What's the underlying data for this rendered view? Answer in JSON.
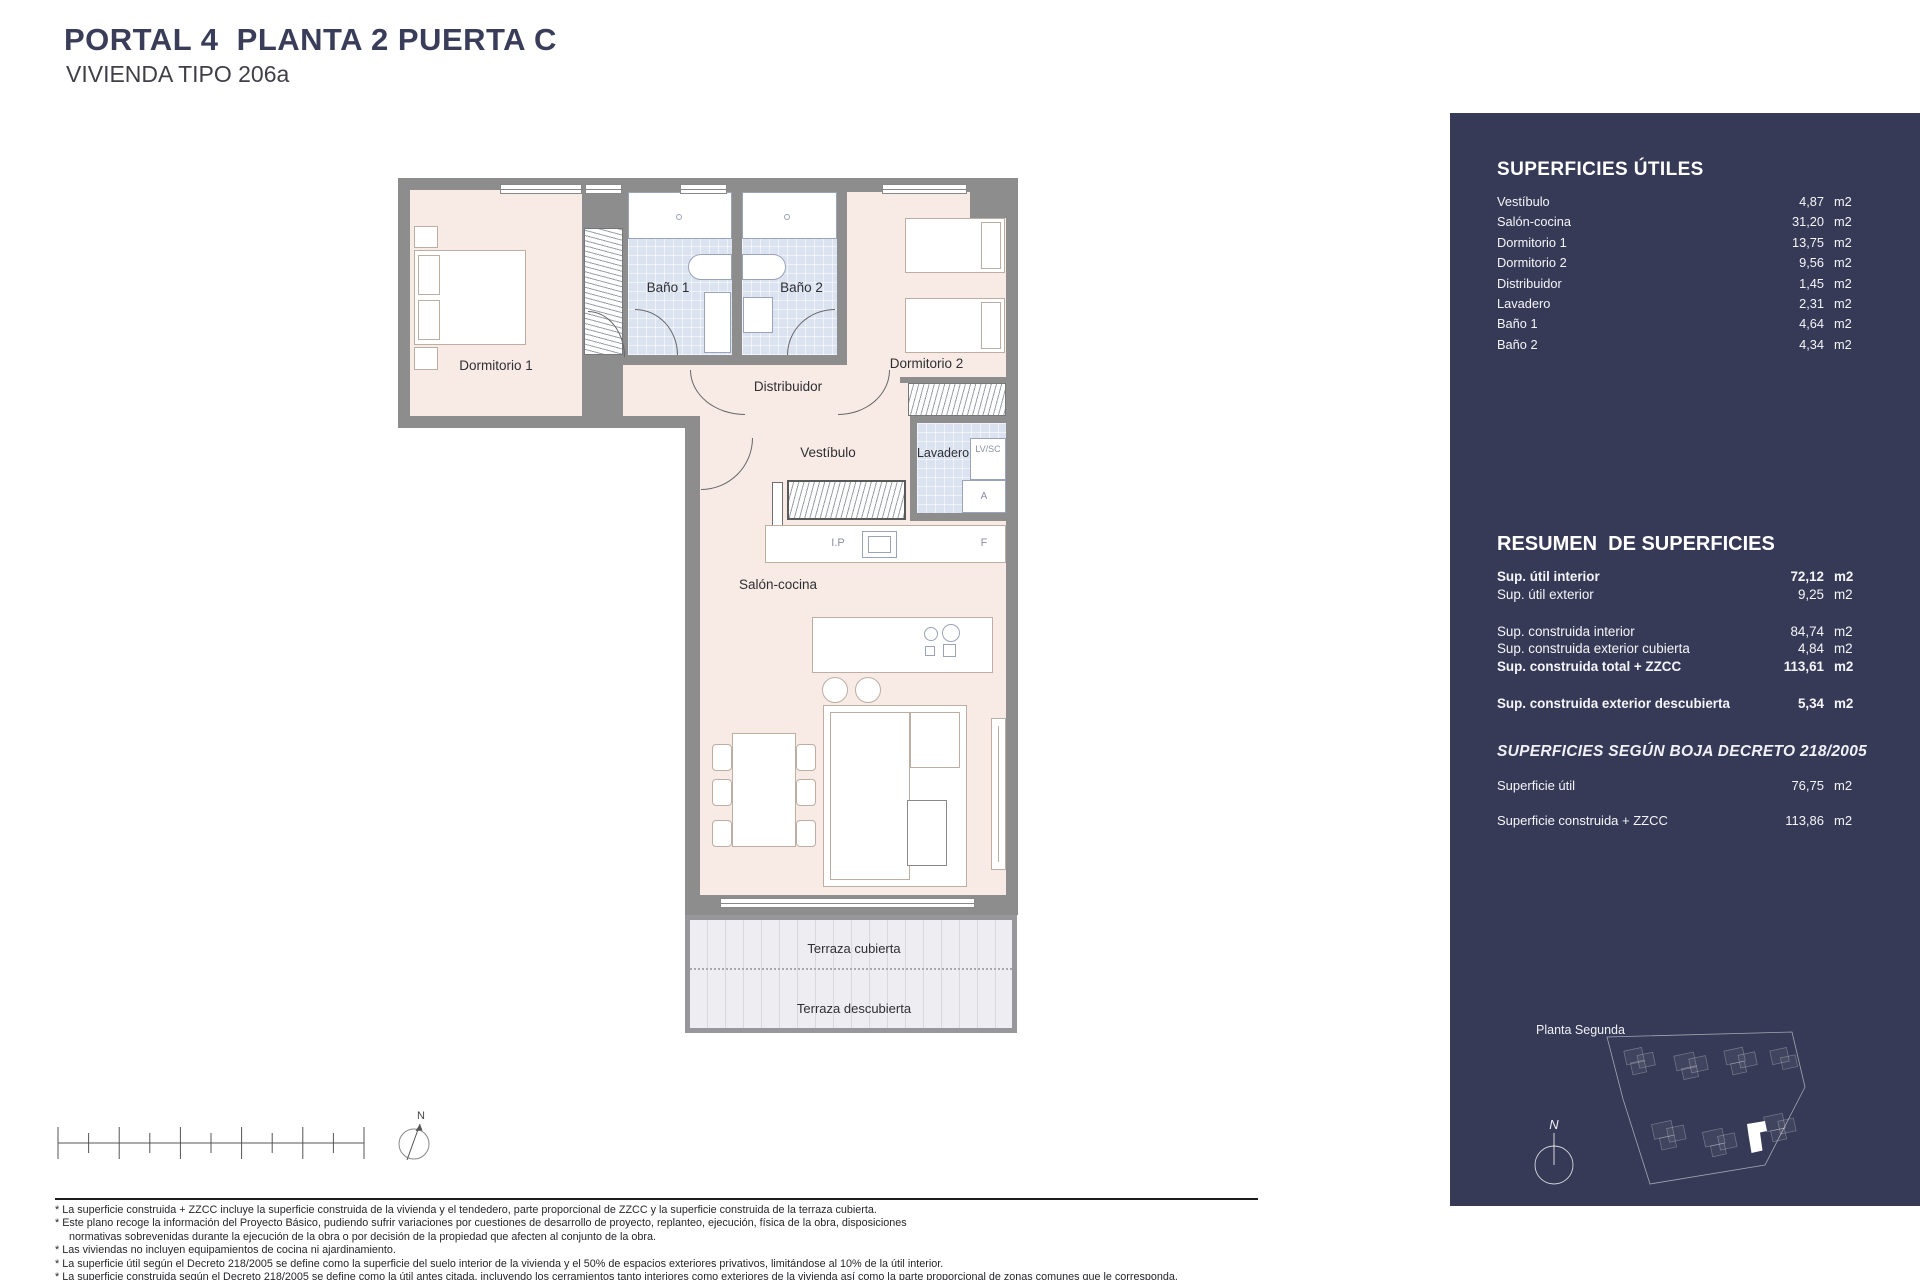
{
  "header": {
    "title": "PORTAL 4  PLANTA 2 PUERTA C",
    "subtitle": "VIVIENDA TIPO 206a"
  },
  "plan": {
    "rooms": {
      "dormitorio1": "Dormitorio 1",
      "bano1": "Baño 1",
      "bano2": "Baño 2",
      "dormitorio2": "Dormitorio 2",
      "distribuidor": "Distribuidor",
      "vestibulo": "Vestíbulo",
      "lavadero": "Lavadero",
      "salon": "Salón-cocina",
      "terraza_cubierta": "Terraza cubierta",
      "terraza_descubierta": "Terraza descubierta"
    },
    "labels": {
      "lv_sc": "LV/SC",
      "a": "A",
      "ip": "I.P",
      "f": "F"
    },
    "north": "N"
  },
  "sidebar": {
    "bg": "#373a56",
    "unit": "m2",
    "superficies_utiles": {
      "title": "SUPERFICIES ÚTILES",
      "rows": [
        {
          "label": "Vestíbulo",
          "value": "4,87"
        },
        {
          "label": "Salón-cocina",
          "value": "31,20"
        },
        {
          "label": "Dormitorio 1",
          "value": "13,75"
        },
        {
          "label": "Dormitorio 2",
          "value": "9,56"
        },
        {
          "label": "Distribuidor",
          "value": "1,45"
        },
        {
          "label": "Lavadero",
          "value": "2,31"
        },
        {
          "label": "Baño 1",
          "value": "4,64"
        },
        {
          "label": "Baño 2",
          "value": "4,34"
        }
      ]
    },
    "resumen": {
      "title": "RESUMEN  DE SUPERFICIES",
      "rows": [
        {
          "label": "Sup. útil interior",
          "value": "72,12"
        },
        {
          "label": "Sup. útil exterior",
          "value": "9,25"
        },
        {
          "label": "Sup. construida interior",
          "value": "84,74"
        },
        {
          "label": "Sup. construida exterior cubierta",
          "value": "4,84"
        },
        {
          "label": "Sup. construida total + ZZCC",
          "value": "113,61"
        },
        {
          "label": "Sup. construida exterior descubierta",
          "value": "5,34"
        }
      ]
    },
    "boja": {
      "title": "SUPERFICIES SEGÚN BOJA DECRETO 218/2005",
      "rows": [
        {
          "label": "Superficie útil",
          "value": "76,75"
        },
        {
          "label": "Superficie construida + ZZCC",
          "value": "113,86"
        }
      ]
    },
    "site": {
      "label": "Planta Segunda",
      "north": "N"
    }
  },
  "footnotes": [
    "* La superficie construida + ZZCC incluye la superficie construida de la vivienda y el tendedero, parte proporcional de ZZCC y la superficie construida de la terraza cubierta.",
    "* Este plano recoge la información del Proyecto Básico, pudiendo sufrir variaciones por cuestiones de desarrollo de proyecto, replanteo, ejecución, física de la obra, disposiciones",
    "normativas sobrevenidas durante la ejecución de la obra o por decisión de la propiedad que afecten al conjunto de la obra.",
    "* Las viviendas no incluyen equipamientos de cocina ni ajardinamiento.",
    "* La superficie útil según el Decreto 218/2005 se define como la superficie del suelo interior de la vivienda y el 50% de espacios exteriores privativos, limitándose al 10% de la útil interior.",
    "* La superficie construida según el Decreto 218/2005 se define como la útil antes citada, incluyendo los cerramientos tanto interiores como exteriores de la vivienda así como la parte proporcional de zonas comunes que le corresponda."
  ]
}
